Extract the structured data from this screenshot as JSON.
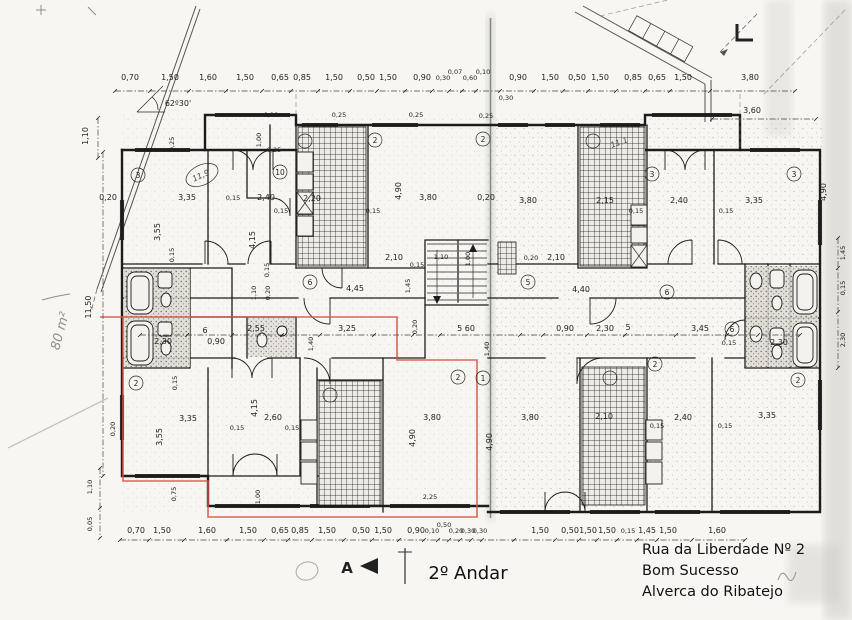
{
  "meta": {
    "floor_label": "2º Andar",
    "address": [
      "Rua da Liberdade Nº 2",
      "Bom Sucesso",
      "Alverca do Ribatejo"
    ],
    "section_marker": "A",
    "area_note": "80 m²",
    "angle_note": "62º30'",
    "colors": {
      "ink": "#1d1c1a",
      "red_outline": "#dd5447",
      "paper": "#f7f6f2",
      "pencil": "#8f8d88"
    }
  },
  "chains": {
    "top": [
      "0,70",
      "1,50",
      "1,60",
      "1,50",
      "0,65",
      "0,85",
      "1,50",
      "0,50",
      "1,50",
      "0,90",
      "0,30",
      "0,07",
      "0,60",
      "0,10",
      "0,90",
      "1,50",
      "0,50",
      "1,50",
      "0,85",
      "0,65",
      "1,50",
      "3,80"
    ],
    "top_secondary": [
      "3,60",
      "0,30",
      "0,25"
    ],
    "bottom": [
      "0,70",
      "1,50",
      "1,60",
      "1,50",
      "0,65",
      "0,85",
      "1,50",
      "0,50",
      "1,50",
      "0,90",
      "0,10",
      "0,50",
      "0,20",
      "0,30",
      "0,30",
      "1,50",
      "0,50",
      "1,50",
      "1,50",
      "0,15",
      "1,45",
      "1,50",
      "1,60"
    ],
    "middle": [
      "2,30",
      "6",
      "0,90",
      "2,55",
      "3,25",
      "1,40",
      "0,20",
      "5 60",
      "1,40",
      "0,90",
      "2,30",
      "5",
      "3,45",
      "0,15",
      "2,30",
      "4,40",
      "0,20",
      "2,10"
    ],
    "left_vertical": [
      "11,50",
      "1,10",
      "1,10",
      "0,05"
    ],
    "right_vertical": [
      "1,45",
      "0,15",
      "2,30"
    ]
  },
  "room_dims": {
    "top_left": [
      "0,20",
      "3,35",
      "0,15",
      "2,40",
      "0,15",
      "2,20",
      "0,15",
      "4,90",
      "3,55",
      "0,15",
      "4,15",
      "0,15",
      "1,00",
      "0,25",
      "0,25",
      "0,10",
      "0,25",
      "0,25",
      "2,10",
      "0,15",
      "1,10",
      "1,00",
      "4,45",
      "1,45",
      "0,20",
      "1,10"
    ],
    "top_right": [
      "0,20",
      "3,80",
      "3,80",
      "2,15",
      "0,15",
      "2,40",
      "0,15",
      "3,35",
      "4,90"
    ],
    "bottom_left": [
      "0,15",
      "3,35",
      "3,55",
      "0,20",
      "4,15",
      "0,15",
      "2,60",
      "0,15",
      "3,80",
      "4,90",
      "0,75",
      "1,00",
      "2,25"
    ],
    "bottom_right": [
      "3,80",
      "4,90",
      "2,10",
      "0,15",
      "2,40",
      "0,15",
      "3,35"
    ]
  },
  "room_tags": [
    "3",
    "10",
    "2",
    "2",
    "3",
    "3",
    "6",
    "5",
    "6",
    "6",
    "2",
    "2",
    "1",
    "2",
    "2"
  ],
  "handwritten": [
    "11,9",
    "11,1"
  ]
}
